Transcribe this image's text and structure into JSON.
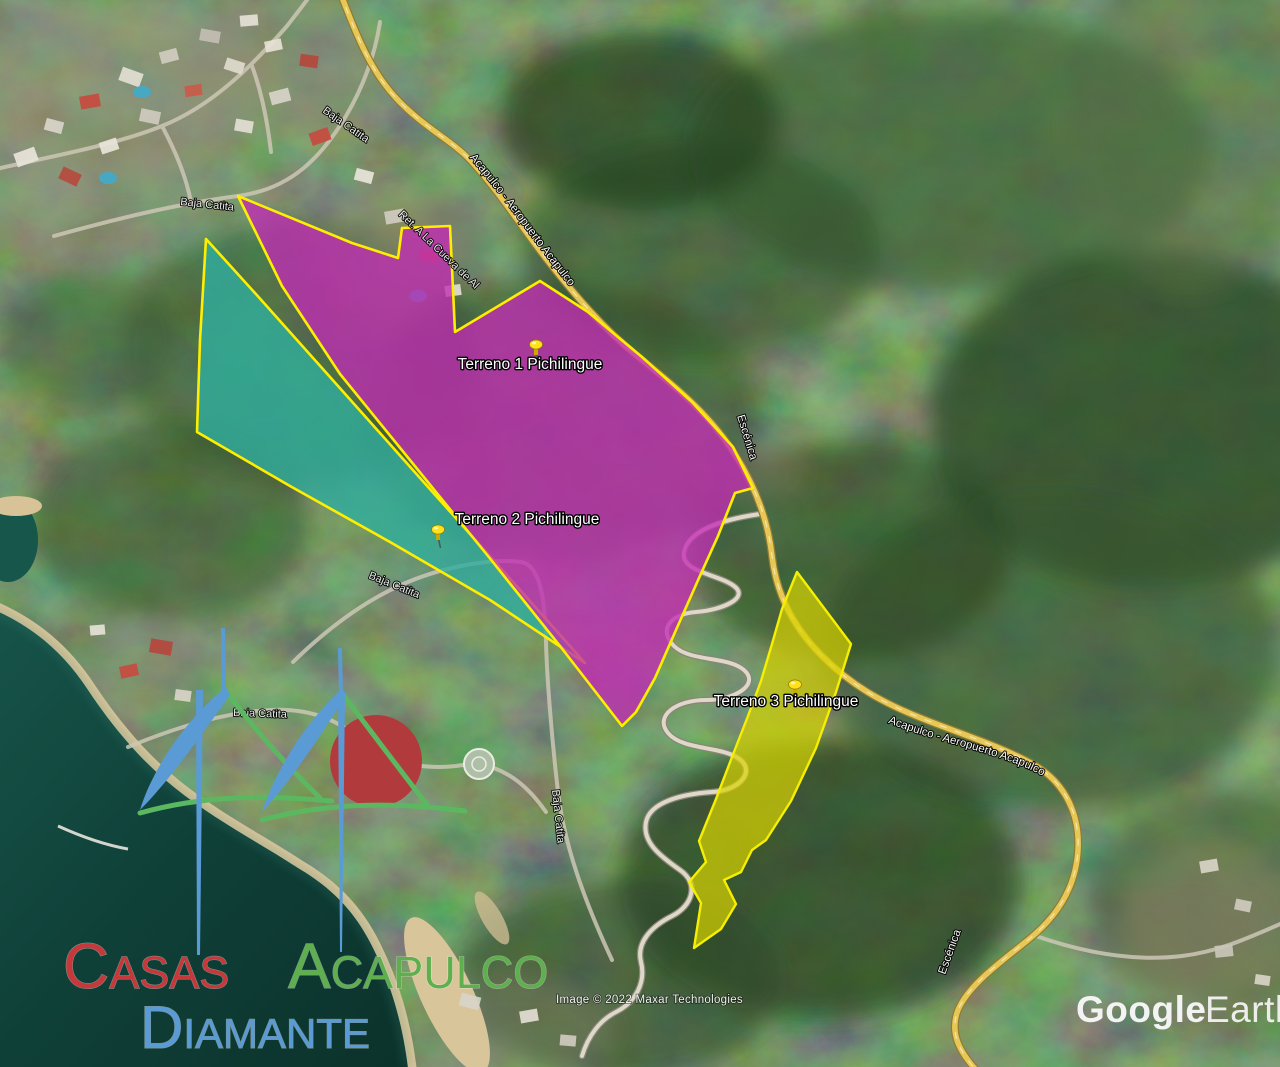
{
  "terrains": [
    {
      "label": "Terreno 1 Pichilingue",
      "fill": "#c22bb4",
      "border": "#ffee00"
    },
    {
      "label": "Terreno 2 Pichilingue",
      "fill": "#2fae9d",
      "border": "#ffee00"
    },
    {
      "label": "Terreno 3 Pichilingue",
      "fill": "#d8d400",
      "border": "#f6ef00"
    }
  ],
  "road_labels": {
    "highway_top": "Acapulco - Aeropuerto Acapulco",
    "highway_right": "Acapulco - Aeropuerto Acapulco",
    "escenica_top": "Escénica",
    "escenica_bottom": "Escénica",
    "retorno": "Ret. A La Cueva de Al",
    "baja_catita": [
      "Baja Catita",
      "Baja Catita",
      "Baja Catita",
      "Baja Catita",
      "Baja Catita"
    ]
  },
  "attribution": "Image © 2022 Maxar Technologies",
  "credit": {
    "google": "Google",
    "earth": "Earth"
  },
  "logo": {
    "word1": "Casas",
    "word2": "Acapulco",
    "word3": "Diamante",
    "color1": "#c5393b",
    "color2": "#5faf4e",
    "color3": "#5b9bd5"
  }
}
